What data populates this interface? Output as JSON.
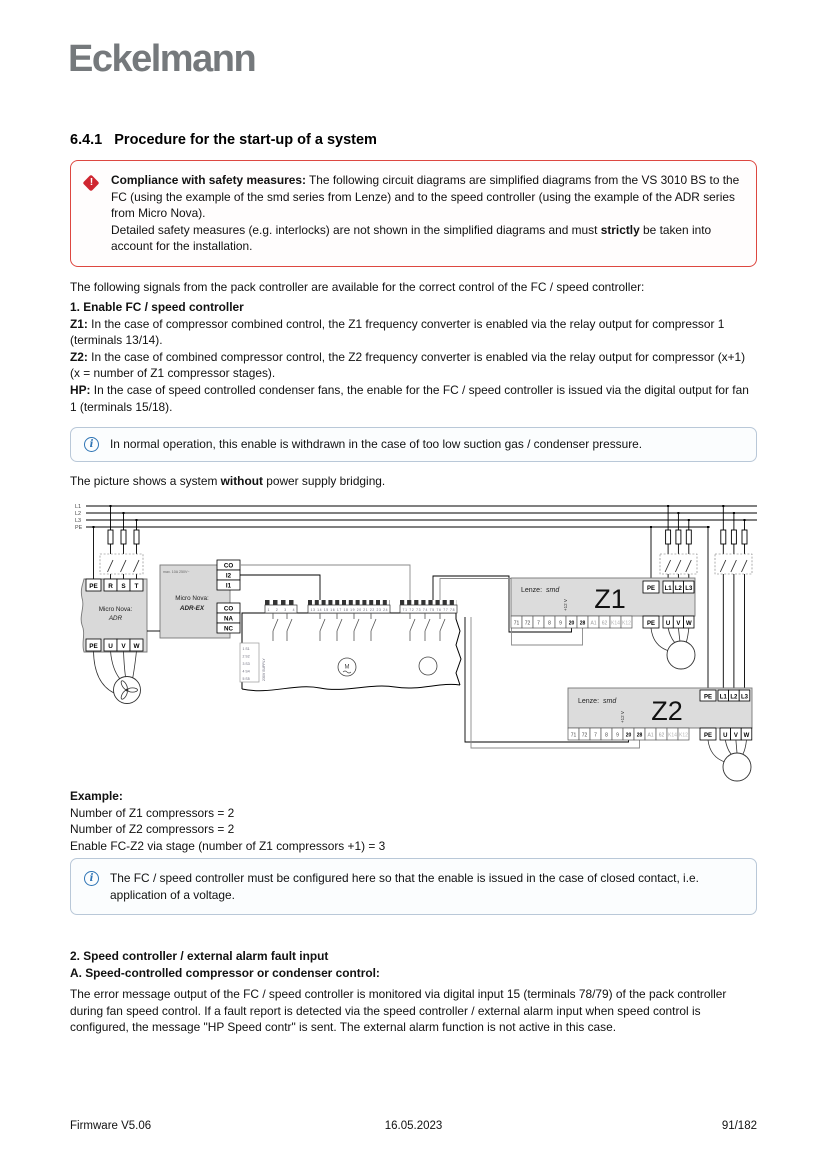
{
  "logo": "Eckelmann",
  "heading": {
    "number": "6.4.1",
    "title": "Procedure for the start-up of a system"
  },
  "colors": {
    "warning_red": "#cf2630",
    "info_blue": "#2e74b5",
    "logo_gray": "#75797c"
  },
  "warning": {
    "icon": "!",
    "lead": "Compliance with safety measures:",
    "text1": " The following circuit diagrams are simplified diagrams from the VS 3010 BS to the FC (using the example of the smd series from Lenze) and to the speed controller (using the example of the ADR series from Micro Nova).",
    "text2_pre": "Detailed safety measures (e.g. interlocks) are not shown in the simplified diagrams and must ",
    "text2_bold": "strictly",
    "text2_post": " be taken into account for the installation."
  },
  "intro": "The following signals from the pack controller are available for the correct control of the FC / speed controller:",
  "section1": {
    "heading": "1. Enable FC / speed controller",
    "items": [
      {
        "lead": "Z1:",
        "text": " In the case of compressor combined control, the Z1 frequency converter is enabled via the relay output for compressor 1 (terminals 13/14)."
      },
      {
        "lead": "Z2:",
        "text": " In the case of combined compressor control, the Z2 frequency converter is enabled via the relay output for compressor (x+1) (x = number of Z1 compressor stages)."
      },
      {
        "lead": "HP:",
        "text": " In the case of speed controlled condenser fans, the enable for the FC / speed controller is issued via the digital output for fan 1 (terminals 15/18)."
      }
    ]
  },
  "info_box1": {
    "icon": "i",
    "text": "In normal operation, this enable is withdrawn in the case of too low suction gas / condenser pressure."
  },
  "picture_note": {
    "pre": "The picture shows a system ",
    "bold": "without",
    "post": " power supply bridging."
  },
  "diagram": {
    "bus": [
      "L1",
      "L2",
      "L3",
      "PE"
    ],
    "adr": {
      "line1": "Micro Nova:",
      "line2": "ADR",
      "top": [
        "PE",
        "R",
        "S",
        "T"
      ],
      "bottom": [
        "PE",
        "U",
        "V",
        "W"
      ]
    },
    "adrex": {
      "line1": "Micro Nova:",
      "line2": "ADR-EX",
      "spec": "max. 10A 250V~",
      "right_top": [
        "CO",
        "I2",
        "I1"
      ],
      "right_bottom": [
        "CO",
        "NA",
        "NC"
      ]
    },
    "controller": {
      "supply_rows": [
        "1 S1",
        "2 S2",
        "3 S3",
        "4 S4",
        "5 S5"
      ],
      "supply_label": "230V SUPPLY",
      "comb_a": "1 2 3 4",
      "comb_b": "13 14 15 16 17 18 19 20 21 22 23 24",
      "comb_c": "71 72 73 74 75 76 77 78",
      "motor_m": "M"
    },
    "z1": {
      "brand": "Lenze:",
      "series": "smd",
      "name": "Z1",
      "enable": "+12 V",
      "pe": "PE",
      "phases": [
        "L1",
        "L2",
        "L3"
      ],
      "strip": [
        "71",
        "72",
        "7",
        "8",
        "9",
        "20",
        "28",
        "A1",
        "62",
        "K14",
        "K12"
      ],
      "out": [
        "U",
        "V",
        "W"
      ]
    },
    "z2": {
      "brand": "Lenze:",
      "series": "smd",
      "name": "Z2",
      "enable": "+12 V",
      "pe": "PE",
      "phases": [
        "L1",
        "L2",
        "L3"
      ],
      "strip": [
        "71",
        "72",
        "7",
        "8",
        "9",
        "20",
        "28",
        "A1",
        "62",
        "K14",
        "K12"
      ],
      "out": [
        "U",
        "V",
        "W"
      ]
    }
  },
  "example": {
    "heading": "Example:",
    "lines": [
      "Number of Z1 compressors = 2",
      "Number of Z2 compressors = 2",
      "Enable FC-Z2 via stage (number of Z1 compressors +1) = 3"
    ]
  },
  "info_box2": {
    "icon": "i",
    "text": "The FC / speed controller must be configured here so that the enable is issued in the case of closed contact, i.e. application of a voltage."
  },
  "section2": {
    "heading1": "2. Speed controller / external alarm fault input",
    "heading2": "A. Speed-controlled compressor or condenser control:",
    "body": "The error message output of the FC / speed controller is monitored via digital input 15 (terminals 78/79) of the pack controller during fan speed control. If a fault report is detected via the speed controller / external alarm input when speed control is configured, the message \"HP Speed contr\" is sent. The external alarm function is not active in this case."
  },
  "footer": {
    "left": "Firmware V5.06",
    "center": "16.05.2023",
    "right": "91/182"
  }
}
